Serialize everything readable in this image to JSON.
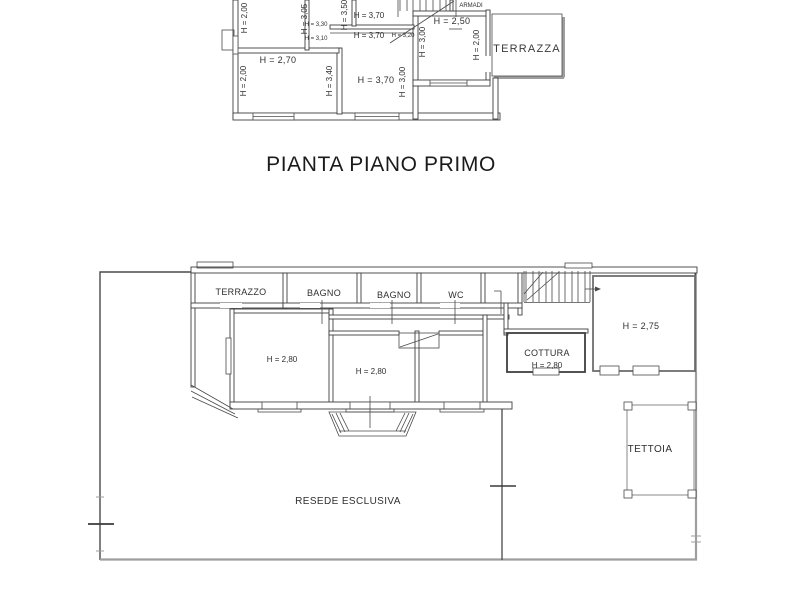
{
  "title": "PIANTA PIANO PRIMO",
  "colors": {
    "wall_line": "#3f3f3f",
    "thin_line": "#4a4a4a",
    "boundary_gray": "#9e9e9e",
    "text": "#2f2f2f",
    "background": "#ffffff"
  },
  "upper_plan": {
    "labels": {
      "h_200_topleft": "H = 2,00",
      "h_305": "H = 3,05",
      "h_350": "H = 3,50",
      "h_370_top": "H = 3,70",
      "h_330": "H = 3,30",
      "h_310": "H = 3,10",
      "h_370_mid": "H = 3,70",
      "h_320": "H = 3,20",
      "h_300_stair": "H = 3,00",
      "h_250": "H = 2,50",
      "h_200_terrace": "H = 2,00",
      "armadi": "ARMADI",
      "terrazza": "TERRAZZA",
      "h_270": "H = 2,70",
      "h_200_left": "H = 2,00",
      "h_340": "H = 3,40",
      "h_370_bottom": "H = 3,70",
      "h_300_right": "H = 3,00"
    }
  },
  "lower_plan": {
    "labels": {
      "terrazzo": "TERRAZZO",
      "bagno_1": "BAGNO",
      "bagno_2": "BAGNO",
      "wc": "WC",
      "h_275": "H = 2,75",
      "cottura": "COTTURA",
      "h_280_cottura": "H = 2,80",
      "h_280_left": "H = 2,80",
      "h_280_mid": "H = 2,80",
      "tettoia": "TETTOIA",
      "resede": "RESEDE ESCLUSIVA"
    }
  }
}
